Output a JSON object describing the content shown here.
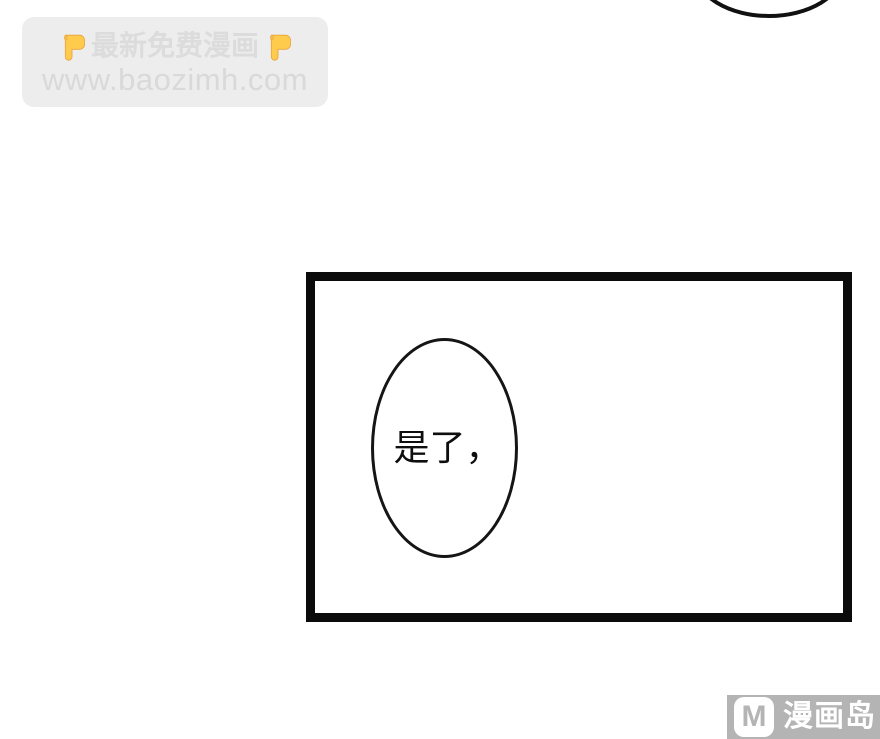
{
  "page": {
    "background": "#ffffff"
  },
  "watermark": {
    "line1": "最新免费漫画",
    "line2": "www.baozimh.com",
    "left_icon": "point-down-emoji",
    "right_icon": "point-down-emoji",
    "box_bg": "#ededed",
    "text_color": "#d9d9d9",
    "emoji_color": "#FFCB4C"
  },
  "comic": {
    "dialogue": "是了，",
    "panel_border_color": "#0b0b0b",
    "bubble_stroke_color": "#151515"
  },
  "logo": {
    "badge_letter": "M",
    "site_name": "漫画岛",
    "bg_color": "#b4b4b4",
    "text_color": "#ffffff"
  }
}
